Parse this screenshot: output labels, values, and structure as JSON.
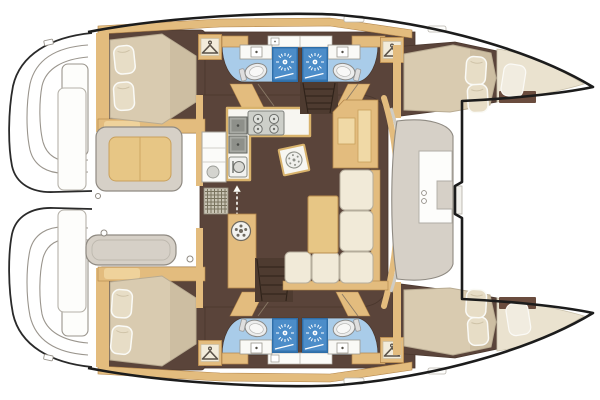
{
  "image": {
    "type": "yacht-floorplan",
    "subject": "catamaran-deck-plan-top-view",
    "orientation": "bow-right-stern-left",
    "width_px": 600,
    "height_px": 400
  },
  "colors": {
    "outline": "#1c1c1c",
    "deck": "#ffffff",
    "floor": "#5a443a",
    "wood": "#e3bc7e",
    "wood_dark": "#b3854a",
    "mattress": "#d9cbb0",
    "mattress_shade": "#c2b193",
    "pillow": "#e7ddc6",
    "cushion": "#f1ead8",
    "bath_floor": "#a9cce9",
    "shower": "#4c8dc9",
    "shower_border": "#2e6ea8",
    "bench": "#d6d0c7",
    "bow_berth": "#eae2cf",
    "table": "#e7c685",
    "counter": "#f7f6f1",
    "stair": "#4e3b30",
    "grate": "#c9c4b4",
    "shelf": "#6a4c3e",
    "deck_line": "#c9c5bc",
    "seat_pad": "#efd29b"
  },
  "rooms": {
    "salon": {
      "features": [
        "galley-l-counter",
        "four-burner-stove",
        "double-sink",
        "oven",
        "round-sink-slab",
        "fridge-unit",
        "entry-mat",
        "entry-arrow",
        "washer-column",
        "l-shaped-sofa",
        "salon-table",
        "nav-desk",
        "stairs-to-port-hull",
        "stairs-to-starboard-hull"
      ]
    },
    "port_hull": {
      "features": [
        "aft-double-cabin",
        "aft-head-toilet",
        "aft-shower-stall",
        "fwd-head-toilet",
        "fwd-shower-stall",
        "wardrobe-aft",
        "wardrobe-fwd",
        "fwd-double-cabin",
        "bow-berth",
        "bow-shelf"
      ]
    },
    "starboard_hull": {
      "features": [
        "aft-double-cabin",
        "aft-head-toilet",
        "aft-shower-stall",
        "fwd-head-toilet",
        "fwd-shower-stall",
        "wardrobe-aft",
        "wardrobe-fwd",
        "fwd-double-cabin",
        "bow-berth",
        "bow-shelf"
      ]
    },
    "aft_cockpit": {
      "features": [
        "bench-with-cushion",
        "aft-bench",
        "transom-steps-port",
        "transom-steps-starboard",
        "deck-hatch-pulls"
      ]
    },
    "fwd_cockpit": {
      "features": [
        "u-shaped-seat",
        "inset-table",
        "cup-holders",
        "crossbeam-step"
      ]
    },
    "trampoline_area": {
      "features": [
        "forward-crossbeam",
        "port-bow-tip",
        "starboard-bow-tip"
      ]
    }
  },
  "icons": {
    "shower": "sunburst-icon",
    "toilet": "toilet-seat-icon",
    "wardrobe": "hanger-icon",
    "stove": "four-burner-icon",
    "washer": "porthole-spokes-icon",
    "entry": "double-headed-dashed-arrow-icon",
    "sink": "faucet-dot-icon"
  }
}
